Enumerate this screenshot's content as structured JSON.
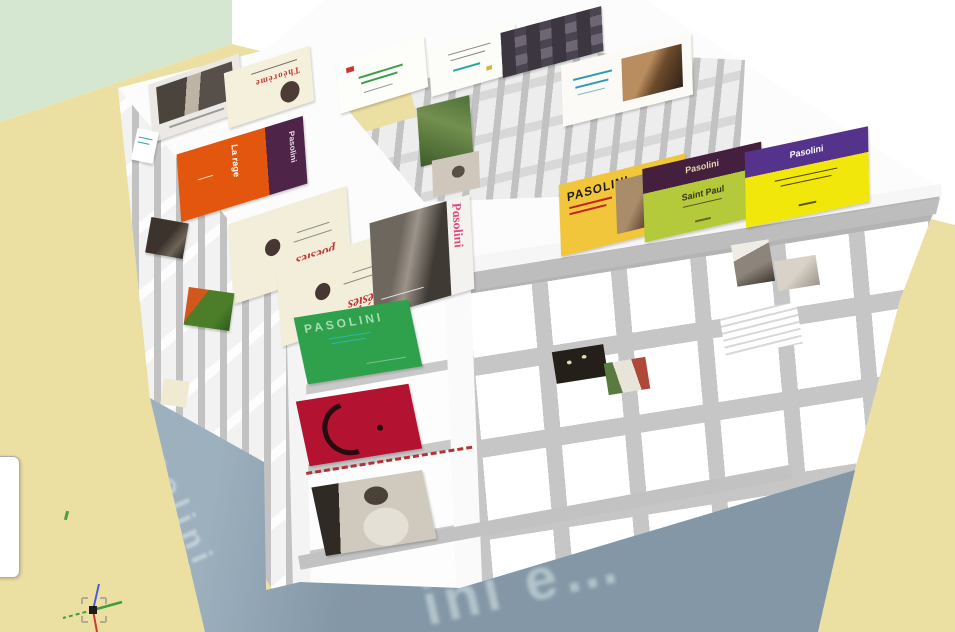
{
  "colors": {
    "wall": "#d5e7d1",
    "floor": "#ecdfa2",
    "base_blue": "#8ba0af",
    "base_text": "#b2c3ca",
    "structure_gray": "#c6c6c6",
    "book_green": "#2fa04c",
    "book_red": "#b31331",
    "book_orange": "#e2560e",
    "book_plum": "#4e2449",
    "book_lime": "#b4ca3a",
    "book_violet": "#55338c",
    "book_yellow": "#f2e70a",
    "magazine_yellow": "#f2c63a",
    "cream": "#f3eeda",
    "axis_red": "#cc3b30",
    "axis_green": "#3f9e3f",
    "axis_blue": "#4a5fd0"
  },
  "base": {
    "text_side": "pasolini",
    "text_side2": "e …",
    "text_bottom": "ini e…"
  },
  "books": {
    "theoreme": {
      "title": "Théorème"
    },
    "la_rage": {
      "title": "La rage",
      "spine": "Pasolini"
    },
    "poesies_a": {
      "title": "poésies"
    },
    "poesies_b": {
      "title": "poésies"
    },
    "portrait": {
      "title": "Pasolini"
    },
    "magazine": {
      "title": "PASOLINI"
    },
    "saint_paul": {
      "top": "Pasolini",
      "title": "Saint Paul"
    },
    "in_situ": {
      "top": "Pasolini"
    },
    "front_green": {
      "title": "PASOLINI"
    }
  },
  "icons": {
    "axes_gizmo": "xyz-axes-icon"
  }
}
